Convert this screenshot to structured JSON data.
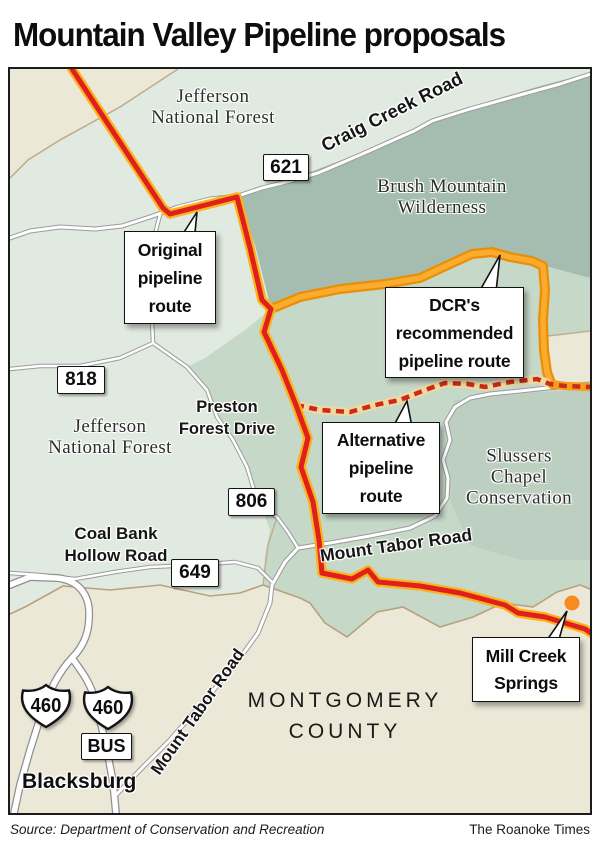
{
  "title": "Mountain Valley Pipeline proposals",
  "footer": {
    "source": "Source: Department of Conservation and Recreation",
    "credit": "The Roanoke Times"
  },
  "map": {
    "area_labels": {
      "jefferson_nf_north": "Jefferson\nNational Forest",
      "brush_mountain_wilderness": "Brush Mountain\nWilderness",
      "jefferson_nf_west": "Jefferson\nNational Forest",
      "slussers_chapel": "Slussers\nChapel\nConservation",
      "montgomery_county": "MONTGOMERY\nCOUNTY",
      "blacksburg": "Blacksburg",
      "mill_creek_springs": "Mill Creek\nSprings"
    },
    "road_labels": {
      "craig_creek_road": "Craig Creek Road",
      "preston_forest_drive": "Preston\nForest Drive",
      "coal_bank_hollow_road": "Coal Bank\nHollow Road",
      "mount_tabor_road_east": "Mount Tabor Road",
      "mount_tabor_road_south": "Mount Tabor Road"
    },
    "shields": {
      "route_621": "621",
      "route_818": "818",
      "route_806": "806",
      "route_649": "649",
      "us_460_left": "460",
      "us_460_right": "460",
      "us_460_bus": "BUS"
    },
    "callouts": {
      "original": "Original\npipeline\nroute",
      "dcr_recommended": "DCR's\nrecommended\npipeline route",
      "alternative": "Alternative\npipeline\nroute"
    },
    "legend_colors": {
      "original_route_red": "#e0201a",
      "route_casing_yellow": "#f9b31f",
      "dcr_route_orange": "#fbab2d",
      "dcr_route_casing": "#e98f06",
      "alternative_dash_red": "#cd2a1a",
      "alternative_dash_casing": "#eed9a2",
      "spring_dot_orange": "#f68b1f",
      "forest_light_green": "#e1eae0",
      "forest_medium_green": "#c6d8c8",
      "wilderness_dark_green": "#a5bdb0",
      "county_beige": "#ece8d7"
    }
  }
}
